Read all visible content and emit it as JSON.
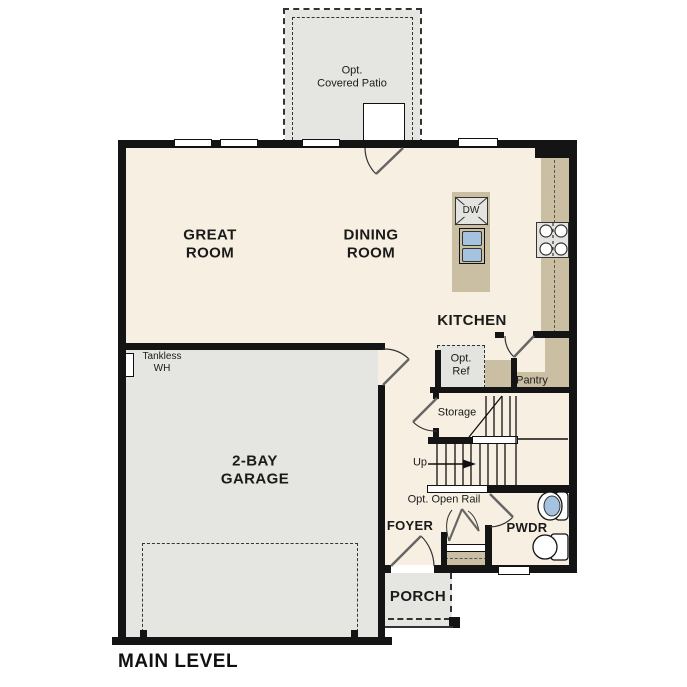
{
  "plan": {
    "title": "MAIN LEVEL",
    "rooms": {
      "patio": {
        "line1": "Opt.",
        "line2": "Covered Patio"
      },
      "great": {
        "line1": "GREAT",
        "line2": "ROOM"
      },
      "dining": {
        "line1": "DINING",
        "line2": "ROOM"
      },
      "kitchen": "KITCHEN",
      "garage": {
        "line1": "2-BAY",
        "line2": "GARAGE"
      },
      "foyer": "FOYER",
      "powder": "PWDR",
      "porch": "PORCH",
      "pantry": "Pantry",
      "storage": "Storage"
    },
    "stairs": {
      "up": "Up",
      "rail": "Opt. Open Rail"
    },
    "fixtures": {
      "dishwasher": "DW",
      "ref_line1": "Opt.",
      "ref_line2": "Ref",
      "wh_line1": "Tankless",
      "wh_line2": "WH"
    },
    "colors": {
      "floor": "#f7efe2",
      "outdoor_gray": "#e5e5e2",
      "cabinet_tan": "#cabfa3",
      "fixture_gray": "#e3e3e0",
      "plumbing_blue": "#a5c2df",
      "wall_black": "#141414"
    }
  }
}
